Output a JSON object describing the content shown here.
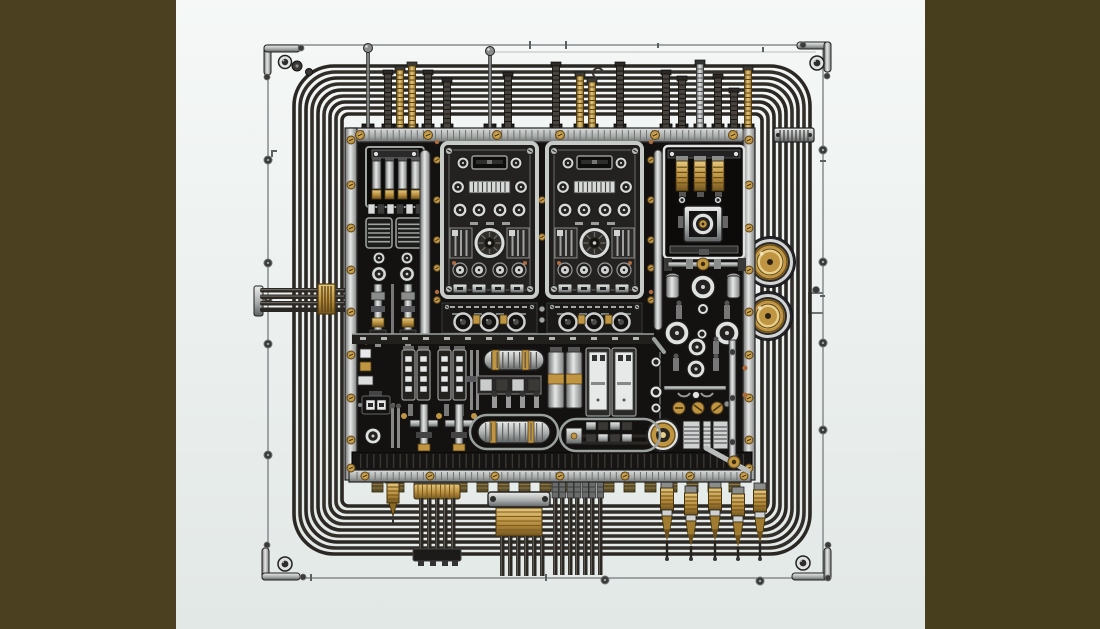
{
  "scene": {
    "description": "Stylized technical illustration of a black industrial electronic control unit: central enclosure with two identical knob panels, fuse modules and valve clusters, surrounded by nine concentric looped wires inside a thin screwed frame, vertical pins on top, brass plug connectors and cable bundles exiting the bottom, two gold coil connectors on the right, olive-drab bars masking both sides of the canvas",
    "colors": {
      "olive_left": "#4b4120",
      "olive_right": "#473e1d",
      "canvas_top": "#f5f8f6",
      "canvas_bottom": "#e2e8e6",
      "frame_line": "#7e8584",
      "wire": "#2b2824",
      "wire_highlight": "#6b665f",
      "box_fill": "#131210",
      "box_inner_line": "#3d3b36",
      "steel_light": "#dfe2e0",
      "steel_mid": "#9fa3a2",
      "steel_dark": "#4a4c4e",
      "brass": "#c09542",
      "brass_light": "#e9cf8c",
      "brass_dark": "#6f521c",
      "copper": "#ad6a3d",
      "white_face": "#e6e9e8",
      "panel_fill": "#242220",
      "panel_frame": "#c7cbc8",
      "ink": "#111111"
    },
    "side_bars": {
      "left_width": 176,
      "right_x": 925
    },
    "frame": {
      "x": 268,
      "y": 45,
      "w": 555,
      "h": 533
    },
    "frame_screws": [
      [
        268,
        160
      ],
      [
        268,
        263
      ],
      [
        268,
        299
      ],
      [
        268,
        344
      ],
      [
        268,
        455
      ],
      [
        823,
        150
      ],
      [
        823,
        262
      ],
      [
        823,
        343
      ],
      [
        823,
        430
      ],
      [
        605,
        580
      ],
      [
        760,
        581
      ]
    ],
    "wire_loops": {
      "count": 9,
      "x": 294,
      "y": 66,
      "w": 516,
      "h": 488,
      "step": 6,
      "radius": 40,
      "stroke": 3.6
    },
    "top_pins": [
      {
        "x": 368,
        "top": 44,
        "style": "rod"
      },
      {
        "x": 388,
        "top": 70,
        "style": "dark"
      },
      {
        "x": 400,
        "top": 66,
        "style": "brass"
      },
      {
        "x": 412,
        "top": 62,
        "style": "brass"
      },
      {
        "x": 428,
        "top": 70,
        "style": "dark"
      },
      {
        "x": 447,
        "top": 78,
        "style": "dark"
      },
      {
        "x": 490,
        "top": 47,
        "style": "rod"
      },
      {
        "x": 508,
        "top": 72,
        "style": "dark"
      },
      {
        "x": 556,
        "top": 62,
        "style": "dark"
      },
      {
        "x": 580,
        "top": 72,
        "style": "brass"
      },
      {
        "x": 592,
        "top": 78,
        "style": "brass"
      },
      {
        "x": 620,
        "top": 62,
        "style": "dark"
      },
      {
        "x": 666,
        "top": 70,
        "style": "dark"
      },
      {
        "x": 682,
        "top": 76,
        "style": "dark"
      },
      {
        "x": 700,
        "top": 60,
        "style": "silver"
      },
      {
        "x": 718,
        "top": 74,
        "style": "dark"
      },
      {
        "x": 734,
        "top": 88,
        "style": "dark"
      },
      {
        "x": 748,
        "top": 66,
        "style": "brass"
      }
    ],
    "control_box": {
      "x": 345,
      "y": 128,
      "w": 410,
      "h": 352,
      "screws_top_x": [
        360,
        428,
        497,
        560,
        655,
        733
      ],
      "screws_bottom_x": [
        365,
        430,
        495,
        560,
        625,
        690,
        744
      ],
      "screws_side_y": [
        140,
        185,
        228,
        270,
        312,
        355,
        398,
        440,
        468
      ],
      "inner_screw_cols": [
        {
          "x": 437,
          "ys": [
            160,
            200,
            240,
            268,
            300
          ]
        },
        {
          "x": 651,
          "ys": [
            160,
            200,
            240,
            268,
            300
          ]
        },
        {
          "x": 542,
          "ys": [
            200,
            237
          ]
        }
      ]
    },
    "panels": {
      "origins": [
        [
          442,
          143
        ],
        [
          547,
          143
        ]
      ],
      "width": 95,
      "height": 154,
      "strip_y": 303
    },
    "gold_coils": [
      {
        "cx": 770,
        "cy": 262,
        "r": 24
      },
      {
        "cx": 768,
        "cy": 316,
        "r": 23
      }
    ],
    "bottom": {
      "stub_row": {
        "x0": 372,
        "x1": 742,
        "step": 21
      },
      "plug_single_x": 393,
      "bundle_b": {
        "x": 414,
        "wires": [
          419,
          427,
          435,
          443,
          451
        ]
      },
      "bundle_c": {
        "wires": [
          500,
          508,
          516,
          524,
          532,
          540
        ]
      },
      "bundle_d": {
        "wires": [
          553,
          560,
          568,
          575,
          583,
          590,
          598
        ]
      },
      "plugs": [
        {
          "x": 667,
          "dy": 0
        },
        {
          "x": 691,
          "dy": 5
        },
        {
          "x": 715,
          "dy": 0
        },
        {
          "x": 738,
          "dy": 6
        },
        {
          "x": 760,
          "dy": 2
        }
      ]
    }
  }
}
